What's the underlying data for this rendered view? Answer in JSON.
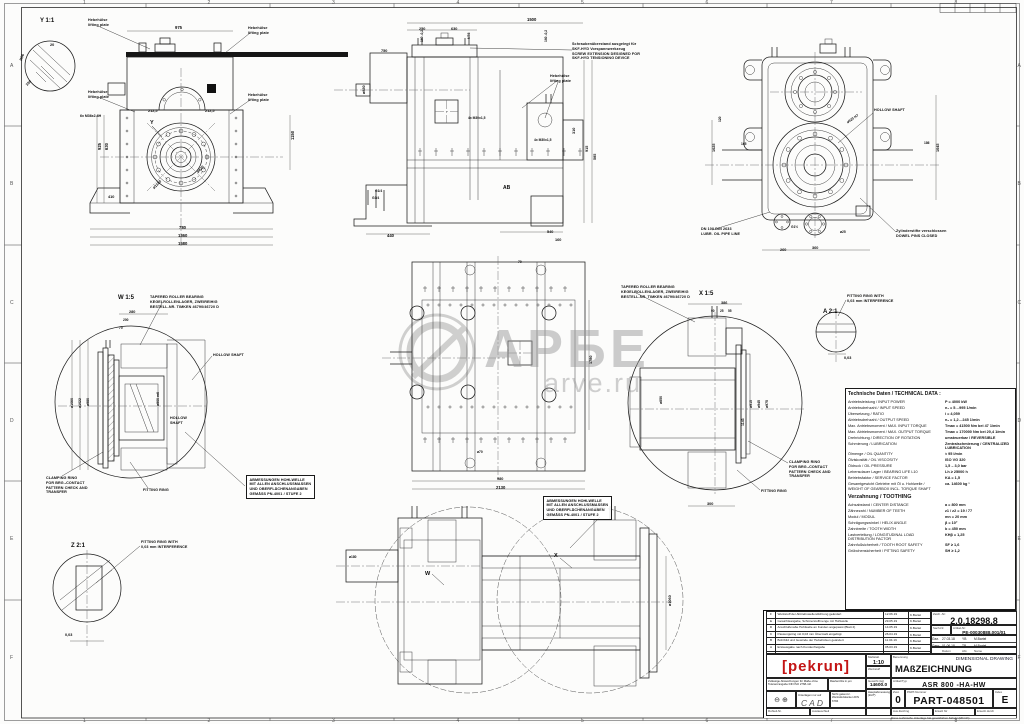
{
  "watermark": {
    "big": "АРБЕ",
    "small": "arve.ru"
  },
  "frame": {
    "top_numbers": [
      "1",
      "2",
      "3",
      "4",
      "5",
      "6",
      "7",
      "8"
    ],
    "side_letters": [
      "A",
      "B",
      "C",
      "D",
      "E",
      "F"
    ]
  },
  "dims": [
    {
      "t": "Y 1:1",
      "x": 40,
      "y": 18,
      "r": 0,
      "s": 6
    },
    {
      "t": "W 1:5",
      "x": 118,
      "y": 295,
      "r": 0,
      "s": 6
    },
    {
      "t": "X 1:5",
      "x": 699,
      "y": 291,
      "r": 0,
      "s": 6
    },
    {
      "t": "A 2:1",
      "x": 823,
      "y": 309,
      "r": 0,
      "s": 6
    },
    {
      "t": "Z 2:1",
      "x": 71,
      "y": 543,
      "r": 0,
      "s": 6
    },
    {
      "t": "Y",
      "x": 150,
      "y": 120,
      "r": 0,
      "s": 5.5
    },
    {
      "t": "W",
      "x": 425,
      "y": 571,
      "r": 0,
      "s": 5.5
    },
    {
      "t": "X",
      "x": 554,
      "y": 553,
      "r": 0,
      "s": 5.5
    },
    {
      "t": "AB",
      "x": 503,
      "y": 185,
      "r": 0,
      "s": 5
    },
    {
      "t": "975",
      "x": 175,
      "y": 25,
      "r": 0
    },
    {
      "t": "20",
      "x": 50,
      "y": 43,
      "r": 0,
      "s": 3.8
    },
    {
      "t": "R56",
      "x": 19,
      "y": 60,
      "r": -70,
      "s": 3.8
    },
    {
      "t": "100",
      "x": 25,
      "y": 84,
      "r": -45,
      "s": 3.8
    },
    {
      "t": "212,5",
      "x": 148,
      "y": 109,
      "r": 0,
      "s": 3.8
    },
    {
      "t": "212,5",
      "x": 205,
      "y": 109,
      "r": 0,
      "s": 3.8
    },
    {
      "t": "ø420",
      "x": 196,
      "y": 171,
      "r": -45,
      "s": 3.8
    },
    {
      "t": "ø1180",
      "x": 152,
      "y": 187,
      "r": -45,
      "s": 3.8
    },
    {
      "t": "630",
      "x": 104,
      "y": 150,
      "r": -90
    },
    {
      "t": "925",
      "x": 97,
      "y": 150,
      "r": -90
    },
    {
      "t": "1150",
      "x": 290,
      "y": 140,
      "r": -90
    },
    {
      "t": "780",
      "x": 179,
      "y": 225,
      "r": 0
    },
    {
      "t": "1360",
      "x": 178,
      "y": 233,
      "r": 0
    },
    {
      "t": "1580",
      "x": 178,
      "y": 241,
      "r": 0
    },
    {
      "t": "410",
      "x": 108,
      "y": 195,
      "r": 0,
      "s": 3.8
    },
    {
      "t": "6x M36x2-6H",
      "x": 80,
      "y": 114,
      "r": 0,
      "s": 3.5
    },
    {
      "t": "1500",
      "x": 527,
      "y": 17,
      "r": 0
    },
    {
      "t": "250",
      "x": 419,
      "y": 27,
      "r": 0,
      "s": 3.8
    },
    {
      "t": "630",
      "x": 451,
      "y": 27,
      "r": 0,
      "s": 3.8
    },
    {
      "t": "160 -0,2",
      "x": 420,
      "y": 42,
      "r": -90,
      "s": 3.3
    },
    {
      "t": "M56",
      "x": 467,
      "y": 39,
      "r": -90,
      "s": 3.3
    },
    {
      "t": "160 -0,2",
      "x": 544,
      "y": 42,
      "r": -90,
      "s": 3.3
    },
    {
      "t": "750",
      "x": 381,
      "y": 49,
      "r": 0,
      "s": 3.8
    },
    {
      "t": "ø850",
      "x": 362,
      "y": 94,
      "r": -90,
      "s": 3.8
    },
    {
      "t": "915",
      "x": 585,
      "y": 152,
      "r": -90,
      "s": 3.8
    },
    {
      "t": "585",
      "x": 593,
      "y": 160,
      "r": -90,
      "s": 3.8
    },
    {
      "t": "310",
      "x": 572,
      "y": 134,
      "r": -90,
      "s": 3.8
    },
    {
      "t": "440",
      "x": 387,
      "y": 233,
      "r": 0
    },
    {
      "t": "540",
      "x": 547,
      "y": 230,
      "r": 0,
      "s": 3.8
    },
    {
      "t": "160",
      "x": 555,
      "y": 238,
      "r": 0,
      "s": 3.8
    },
    {
      "t": "G1/4",
      "x": 375,
      "y": 189,
      "r": 0,
      "s": 3.3
    },
    {
      "t": "G3/4",
      "x": 372,
      "y": 196,
      "r": 0,
      "s": 3.3
    },
    {
      "t": "4x M30x1,5",
      "x": 468,
      "y": 116,
      "r": 0,
      "s": 3.3
    },
    {
      "t": "4x M30x1,5",
      "x": 534,
      "y": 138,
      "r": 0,
      "s": 3.3
    },
    {
      "t": "1045",
      "x": 936,
      "y": 152,
      "r": -90,
      "s": 3.8
    },
    {
      "t": "1025",
      "x": 712,
      "y": 152,
      "r": -90,
      "s": 3.8
    },
    {
      "t": "165",
      "x": 741,
      "y": 142,
      "r": 0,
      "s": 3.3
    },
    {
      "t": "186",
      "x": 924,
      "y": 141,
      "r": 0,
      "s": 3.3
    },
    {
      "t": "ø920 H7",
      "x": 846,
      "y": 121,
      "r": -35,
      "s": 3.5
    },
    {
      "t": "260",
      "x": 780,
      "y": 248,
      "r": 0,
      "s": 3.8
    },
    {
      "t": "360",
      "x": 812,
      "y": 246,
      "r": 0,
      "s": 3.8
    },
    {
      "t": "ø25",
      "x": 840,
      "y": 230,
      "r": 0,
      "s": 3.3
    },
    {
      "t": "G1½",
      "x": 791,
      "y": 225,
      "r": 0,
      "s": 3.3
    },
    {
      "t": "120",
      "x": 718,
      "y": 122,
      "r": -90,
      "s": 3.3
    },
    {
      "t": "980",
      "x": 497,
      "y": 477,
      "r": 0,
      "s": 3.8
    },
    {
      "t": "2130",
      "x": 496,
      "y": 485,
      "r": 0
    },
    {
      "t": "1780",
      "x": 589,
      "y": 364,
      "r": -90,
      "s": 3.8
    },
    {
      "t": "ø70",
      "x": 477,
      "y": 450,
      "r": 0,
      "s": 3.3
    },
    {
      "t": "70",
      "x": 518,
      "y": 260,
      "r": 0,
      "s": 3.3
    },
    {
      "t": "280",
      "x": 129,
      "y": 310,
      "r": 0,
      "s": 3.8
    },
    {
      "t": "200",
      "x": 123,
      "y": 318,
      "r": 0,
      "s": 3.3
    },
    {
      "t": "70",
      "x": 119,
      "y": 326,
      "r": 0,
      "s": 3.3
    },
    {
      "t": "ø1060",
      "x": 70,
      "y": 408,
      "r": -90,
      "s": 3.5
    },
    {
      "t": "ø1022",
      "x": 78,
      "y": 408,
      "r": -90,
      "s": 3.5
    },
    {
      "t": "ø980",
      "x": 86,
      "y": 406,
      "r": -90,
      "s": 3.5
    },
    {
      "t": "ø900 m6",
      "x": 156,
      "y": 406,
      "r": -90,
      "s": 3.5
    },
    {
      "t": "386",
      "x": 721,
      "y": 301,
      "r": 0,
      "s": 3.8
    },
    {
      "t": "90",
      "x": 711,
      "y": 309,
      "r": 0,
      "s": 3.2
    },
    {
      "t": "25",
      "x": 720,
      "y": 309,
      "r": 0,
      "s": 3.2
    },
    {
      "t": "55",
      "x": 728,
      "y": 309,
      "r": 0,
      "s": 3.2
    },
    {
      "t": "ø915",
      "x": 749,
      "y": 408,
      "r": -90,
      "s": 3.5
    },
    {
      "t": "ø945",
      "x": 757,
      "y": 408,
      "r": -90,
      "s": 3.5
    },
    {
      "t": "ø975",
      "x": 765,
      "y": 408,
      "r": -90,
      "s": 3.5
    },
    {
      "t": "ø850",
      "x": 659,
      "y": 404,
      "r": -90,
      "s": 3.5
    },
    {
      "t": "1143",
      "x": 741,
      "y": 426,
      "r": -90,
      "s": 3.5
    },
    {
      "t": "300",
      "x": 707,
      "y": 502,
      "r": 0,
      "s": 3.8
    },
    {
      "t": "0,03",
      "x": 844,
      "y": 356,
      "r": 0,
      "s": 3.8
    },
    {
      "t": "0,03",
      "x": 65,
      "y": 633,
      "r": 0,
      "s": 3.8
    },
    {
      "t": "ø1060",
      "x": 668,
      "y": 606,
      "r": -90,
      "s": 3.8
    },
    {
      "t": "ø180",
      "x": 349,
      "y": 555,
      "r": 0,
      "s": 3.3
    }
  ],
  "notes": [
    {
      "x": 88,
      "y": 18,
      "lines": [
        "Hebehülse",
        "lifting plate"
      ]
    },
    {
      "x": 248,
      "y": 26,
      "lines": [
        "Hebehülse",
        "lifting plate"
      ]
    },
    {
      "x": 88,
      "y": 90,
      "lines": [
        "Hebehülse",
        "lifting plate"
      ]
    },
    {
      "x": 248,
      "y": 93,
      "lines": [
        "Hebehülse",
        "lifting plate"
      ]
    },
    {
      "x": 550,
      "y": 74,
      "lines": [
        "Hebehülse",
        "lifting plate"
      ]
    },
    {
      "x": 572,
      "y": 42,
      "lines": [
        "Schraubenüberstand ausgelegt für",
        "SKF-HYD Vorspannwerkzeug",
        "SCREW EXTENSION DESIGNED FOR",
        "SKF-HYD TENSIONING DEVICE"
      ]
    },
    {
      "x": 874,
      "y": 108,
      "lines": [
        "HOLLOW SHAFT"
      ]
    },
    {
      "x": 701,
      "y": 227,
      "lines": [
        "DN 100 DIN 2633",
        "LUBR. OIL PIPE LINE"
      ]
    },
    {
      "x": 896,
      "y": 229,
      "lines": [
        "Zylinderstifte verschlossen",
        "DOWEL PINS CLOSED"
      ]
    },
    {
      "x": 150,
      "y": 295,
      "lines": [
        "TAPERED ROLLER BEARING",
        "KEGELROLLENLAGER, ZWEIREIHIG",
        "BESTELL-NR. TIMKEN 46790/46720 D"
      ]
    },
    {
      "x": 213,
      "y": 353,
      "lines": [
        "HOLLOW SHAFT"
      ]
    },
    {
      "x": 170,
      "y": 416,
      "lines": [
        "HOLLOW",
        "SHAFT"
      ]
    },
    {
      "x": 46,
      "y": 476,
      "lines": [
        "CLAMPING RING",
        "FOR BRG.-CONTACT",
        "PATTERN CHECK AND",
        "TRANSFER"
      ]
    },
    {
      "x": 143,
      "y": 488,
      "lines": [
        "FITTING RING"
      ]
    },
    {
      "x": 246,
      "y": 475,
      "boxed": true,
      "lines": [
        "ABMESSUNGEN HOHLWELLE",
        "MIT ALLEN ANSCHLUSSMASSEN",
        "UND OBERFLÄCHENANGABEN",
        "GEMÄSS PN-4001 / STUFE 2"
      ]
    },
    {
      "x": 621,
      "y": 285,
      "lines": [
        "TAPERED ROLLER BEARING",
        "KEGELROLLENLAGER, ZWEIREIHIG",
        "BESTELL-NR. TIMKEN 46790/46720 D"
      ]
    },
    {
      "x": 789,
      "y": 460,
      "lines": [
        "CLAMPING RING",
        "FOR BRG.-CONTACT",
        "PATTERN CHECK AND",
        "TRANSFER"
      ]
    },
    {
      "x": 761,
      "y": 489,
      "lines": [
        "FITTING RING"
      ]
    },
    {
      "x": 847,
      "y": 294,
      "lines": [
        "FITTING RING WITH",
        "0,03 mm INTERFERENCE"
      ]
    },
    {
      "x": 141,
      "y": 540,
      "lines": [
        "FITTING RING WITH",
        "0,03 mm INTERFERENCE"
      ]
    },
    {
      "x": 543,
      "y": 496,
      "boxed": true,
      "lines": [
        "ABMESSUNGEN HOHLWELLE",
        "MIT ALLEN ANSCHLUSSMASSEN",
        "UND OBERFLÄCHENANGABEN",
        "GEMÄSS PN-4001 / STUFE 2"
      ]
    }
  ],
  "tech_table": {
    "title": "Technische Daten / TECHNICAL DATA :",
    "rows": [
      {
        "l": "Antriebsleistung / INPUT POWER",
        "v": "P = 4000 kW"
      },
      {
        "l": "Antriebsdrehzahl / INPUT SPEED",
        "v": "n₁ = 5…995 1/min"
      },
      {
        "l": "Übersetzung / RATIO",
        "v": "i = 4,059"
      },
      {
        "l": "Abtriebsdrehzahl / OUTPUT SPEED",
        "v": "n₂ = 1,2…245 1/min"
      },
      {
        "l": "Max. Antriebsmoment / MAX. INPUT TORQUE",
        "v": "Tmax = 41500 Nm bei 47 1/min"
      },
      {
        "l": "Max. Abtriebsmoment / MAX. OUTPUT TORQUE",
        "v": "Tmax = 170000 Nm bei 20,4 1/min"
      },
      {
        "l": "Drehrichtung / DIRECTION OF ROTATION",
        "v": "umsteuerbar / REVERSIBLE"
      },
      {
        "l": "Schmierung / LUBRICATION",
        "v": "Zentralschmierung / CENTRALIZED LUBRICATION"
      },
      {
        "l": "Ölmenge / OIL QUANTITY",
        "v": "≈ 95 l/min"
      },
      {
        "l": "Ölviskosität / OIL VISCOSITY",
        "v": "ISO VG 320"
      },
      {
        "l": "Öldruck / OIL PRESSURE",
        "v": "1,5 – 3,0 bar"
      },
      {
        "l": "Lebensdauer Lager / BEARING LIFE L10",
        "v": "Lh ≥ 25000 h"
      },
      {
        "l": "Betriebsfaktor / SERVICE FACTOR",
        "v": "KA = 1,5"
      },
      {
        "l": "Gesamtgewicht Getriebe mit Öl u. Hohlwelle /|WEIGHT OF GEARBOX INCL. TORQUE SHAFT",
        "v": "ca. 14600 kg ¹"
      },
      {
        "section": "Verzahnung / TOOTHING"
      },
      {
        "l": "Achsabstand / CENTER DISTANCE",
        "v": "a = 800 mm"
      },
      {
        "l": "Zähnezahl / NUMBER OF TEETH",
        "v": "z1 / z2 = 19 / 77"
      },
      {
        "l": "Modul / MODUL",
        "v": "mn = 20 mm"
      },
      {
        "l": "Schrägungswinkel / HELIX ANGLE",
        "v": "β = 10°"
      },
      {
        "l": "Zahnbreite / TOOTH WIDTH",
        "v": "b = 450 mm"
      },
      {
        "l": "Lastverteilung / LONGITUDINAL LOAD|DISTRIBUTION FACTOR",
        "v": "KHβ = 1,25"
      },
      {
        "l": "Zahnfußsicherheit / TOOTH ROOT SAFETY",
        "v": "SF ≥ 1,6"
      },
      {
        "l": "Grübchensicherheit / PITTING SAFETY",
        "v": "SH ≥ 1,2"
      }
    ]
  },
  "revisions": {
    "header": {
      "zust": "Zust.",
      "punkt": "Punkt",
      "besch": "Änderungsbeschreibung",
      "datum": "Datum",
      "name": "Name"
    },
    "rows": [
      {
        "idx": "F",
        "txt": "Werkstoff der Abtriebswellendichtung geändert",
        "date": "12.06.19",
        "name": "K.Bartel"
      },
      {
        "idx": "E",
        "txt": "Gewichtsangabe, Schmierstoffmenge mit Hohlwelle",
        "date": "29.05.19",
        "name": "K.Bartel"
      },
      {
        "idx": "D",
        "txt": "Anschlußmaße Hohlwelle an Kunden angepasst (Blatt 2)",
        "date": "14.05.19",
        "name": "K.Bartel"
      },
      {
        "idx": "C",
        "txt": "Passungsring mit 0,03 mm Übermaß eingefügt",
        "date": "26.04.19",
        "name": "K.Bartel"
      },
      {
        "idx": "B",
        "txt": "Bohrbild und Gewinde der Hebehülsen geändert",
        "date": "11.04.19",
        "name": "K.Bartel"
      },
      {
        "idx": "A",
        "txt": "Erstausgabe nach Kundenfreigabe",
        "date": "05.03.19",
        "name": "K.Bartel"
      }
    ]
  },
  "titleblock": {
    "zeichnr_label": "Zeich.-Nr:",
    "zeichnr": "2.0.18298.8",
    "sachnr_label": "Sach-Nr.",
    "artikelnr_label": "Artikel-Nr:",
    "artikelnr": "PE-00030888.001/01",
    "approvals": [
      {
        "k": "Gez.",
        "d": "27.03.18",
        "a": "YB",
        "n": "M.Bartel"
      },
      {
        "k": "Gepr.",
        "d": "01.06.18",
        "a": "TB",
        "n": "M.Bartel"
      }
    ],
    "approv_head": {
      "d": "Datum",
      "a": "Abt.",
      "n": "Name"
    },
    "logo": "[pekrun]",
    "massstab_label": "Maßstab",
    "massstab": "1:10",
    "werkstoff_label": "Werkstoff",
    "benennung_label": "Benennung",
    "title_en": "DIMENSIONAL DRAWING",
    "title_de": "MAßZEICHNUNG",
    "typ_label": "Artikel/Typ:",
    "typ": "ASR 800 -HA-HW",
    "zust_label": "Zust.",
    "zust": "0",
    "part_label": "PART-Nummer",
    "part": "PART-048501",
    "index_label": "Index",
    "index": "E",
    "gewicht_label": "Gewicht (kg)",
    "gewicht": "14600.0",
    "haupt1": "Hauptabmessungen",
    "haupt2": "(Zoll*)",
    "tol_text": "Zulässige Abweichungen für Maße ohne Toleranzangabe DIN ISO 2768-mK",
    "ra_text": "Rauheit Ra in µm",
    "proj_symbols": "⊖ ⊕",
    "cad_label": "Unterlagen nur auf",
    "cad": "CAD",
    "kanten_text": "Nicht gekennz. Werkstückkanten DIN 6784",
    "rohteil": "Rohteil-Nr.",
    "austausch": "Austauschteil",
    "auszeichng": "Aus.Zeichng",
    "ersatz": "Ersatz für",
    "ersetzt": "Ersetzt durch",
    "schutz": "Diese technische Unterlage hat gesetzlichen Schutz (DIN 34)"
  }
}
